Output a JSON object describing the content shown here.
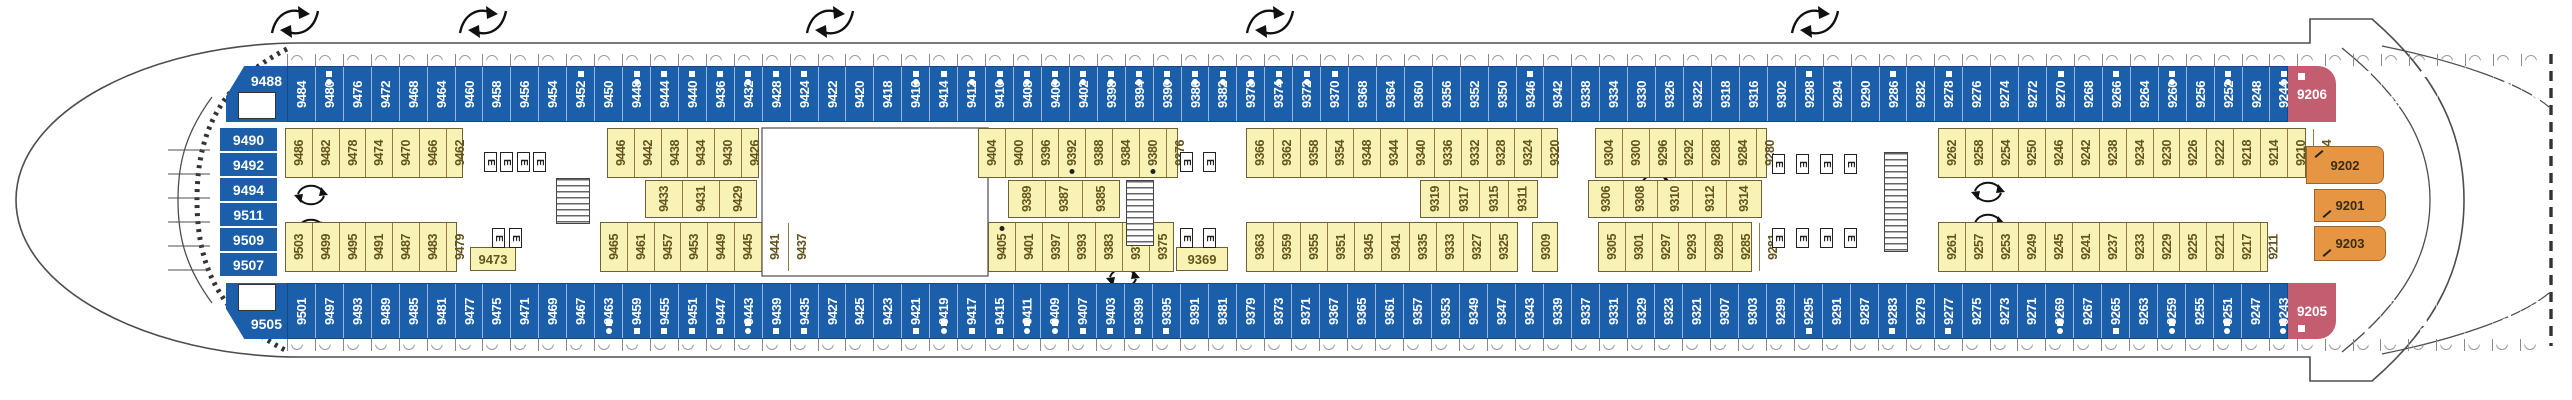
{
  "title": "ship-deck-plan",
  "colors": {
    "cabin_blue": "#1b5ea9",
    "cabin_yellow": "#f8f2b5",
    "cabin_pink": "#c35e70",
    "cabin_orange": "#e69643",
    "yellow_text": "#63531d",
    "hull_line": "#4d4d4d"
  },
  "left_labels": {
    "top": "9488",
    "column": [
      "9490",
      "9492",
      "9494",
      "9511",
      "9509",
      "9507"
    ],
    "bottom": "9505"
  },
  "blue_top": {
    "x": 287,
    "y": 66,
    "w": 2001,
    "h": 56,
    "cabins": [
      "9484",
      "9480",
      "9476",
      "9472",
      "9468",
      "9464",
      "9460",
      "9458",
      "9456",
      "9454",
      "9452",
      "9450",
      "9448",
      "9444",
      "9440",
      "9436",
      "9432",
      "9428",
      "9424",
      "9422",
      "9420",
      "9418",
      "9416",
      "9414",
      "9412",
      "9410",
      "9408",
      "9406",
      "9402",
      "9398",
      "9394",
      "9390",
      "9386",
      "9382",
      "9378",
      "9374",
      "9372",
      "9370",
      "9368",
      "9364",
      "9360",
      "9356",
      "9352",
      "9350",
      "9346",
      "9342",
      "9338",
      "9334",
      "9330",
      "9326",
      "9322",
      "9318",
      "9316",
      "9302",
      "9298",
      "9294",
      "9290",
      "9286",
      "9282",
      "9278",
      "9276",
      "9274",
      "9272",
      "9270",
      "9268",
      "9266",
      "9264",
      "9260",
      "9256",
      "9252",
      "9248",
      "9244",
      "9240",
      "9236",
      "9232",
      "9228",
      "9224",
      "9220",
      "9216",
      "9212",
      "9208"
    ]
  },
  "blue_bottom": {
    "x": 287,
    "y": 283,
    "w": 2001,
    "h": 56,
    "cabins": [
      "9501",
      "9497",
      "9493",
      "9489",
      "9485",
      "9481",
      "9477",
      "9475",
      "9471",
      "9469",
      "9467",
      "9463",
      "9459",
      "9455",
      "9451",
      "9447",
      "9443",
      "9439",
      "9435",
      "9427",
      "9425",
      "9423",
      "9421",
      "9419",
      "9417",
      "9415",
      "9411",
      "9409",
      "9407",
      "9403",
      "9399",
      "9395",
      "9391",
      "9381",
      "9379",
      "9373",
      "9371",
      "9367",
      "9365",
      "9361",
      "9357",
      "9353",
      "9349",
      "9347",
      "9343",
      "9339",
      "9337",
      "9331",
      "9329",
      "9323",
      "9321",
      "9307",
      "9303",
      "9299",
      "9295",
      "9291",
      "9287",
      "9283",
      "9279",
      "9277",
      "9275",
      "9273",
      "9271",
      "9269",
      "9267",
      "9265",
      "9263",
      "9259",
      "9255",
      "9251",
      "9247",
      "9243",
      "9239",
      "9235",
      "9231",
      "9227",
      "9223",
      "9219",
      "9215",
      "9209",
      "9207"
    ]
  },
  "marks": {
    "square_dot": [
      "9480",
      "9448",
      "9432",
      "9416",
      "9412",
      "9410",
      "9408",
      "9406",
      "9402",
      "9398",
      "9394",
      "9390",
      "9386",
      "9382",
      "9378",
      "9374",
      "9372",
      "9260",
      "9252",
      "9244",
      "9232",
      "9224",
      "9208",
      "9463",
      "9443",
      "9419",
      "9411",
      "9409",
      "9269",
      "9259",
      "9251",
      "9243",
      "9231",
      "9223"
    ],
    "square": [
      "9452",
      "9444",
      "9440",
      "9436",
      "9428",
      "9424",
      "9414",
      "9370",
      "9346",
      "9298",
      "9286",
      "9278",
      "9270",
      "9266",
      "9212",
      "9459",
      "9455",
      "9451",
      "9447",
      "9439",
      "9435",
      "9421",
      "9417",
      "9415",
      "9407",
      "9403",
      "9399",
      "9395",
      "9295",
      "9283",
      "9277",
      "9265",
      "9209",
      "9207"
    ],
    "dot_black": [
      "9392",
      "9380",
      "9405"
    ]
  },
  "yellow_upper": [
    {
      "x": 285,
      "w": 178,
      "cabins": [
        "9486",
        "9482",
        "9478",
        "9474",
        "9470",
        "9466",
        "9462"
      ]
    },
    {
      "x": 607,
      "w": 152,
      "cabins": [
        "9446",
        "9442",
        "9438",
        "9434",
        "9430",
        "9426"
      ]
    },
    {
      "x": 978,
      "w": 200,
      "cabins": [
        "9404",
        "9400",
        "9396",
        "9392",
        "9388",
        "9384",
        "9380",
        "9376"
      ]
    },
    {
      "x": 1246,
      "w": 312,
      "cabins": [
        "9366",
        "9362",
        "9358",
        "9354",
        "9348",
        "9344",
        "9340",
        "9336",
        "9332",
        "9328",
        "9324",
        "9320"
      ]
    },
    {
      "x": 1595,
      "w": 172,
      "cabins": [
        "9304",
        "9300",
        "9296",
        "9292",
        "9288",
        "9284",
        "9280"
      ]
    },
    {
      "x": 1938,
      "w": 368,
      "cabins": [
        "9262",
        "9258",
        "9254",
        "9250",
        "9246",
        "9242",
        "9238",
        "9234",
        "9230",
        "9226",
        "9222",
        "9218",
        "9214",
        "9210",
        "9204"
      ]
    }
  ],
  "inner_row": [
    {
      "x": 645,
      "w": 112,
      "cabins": [
        "9433",
        "9431",
        "9429"
      ]
    },
    {
      "x": 1008,
      "w": 112,
      "cabins": [
        "9389",
        "9387",
        "9385"
      ]
    },
    {
      "x": 1420,
      "w": 118,
      "cabins": [
        "9319",
        "9317",
        "9315",
        "9311"
      ]
    },
    {
      "x": 1588,
      "w": 174,
      "cabins": [
        "9306",
        "9308",
        "9310",
        "9312",
        "9314"
      ]
    }
  ],
  "yellow_lower": [
    {
      "x": 285,
      "w": 172,
      "cabins": [
        "9503",
        "9499",
        "9495",
        "9491",
        "9487",
        "9483",
        "9479"
      ]
    },
    {
      "x": 600,
      "w": 162,
      "cabins": [
        "9465",
        "9461",
        "9457",
        "9453",
        "9449",
        "9445",
        "9441",
        "9437"
      ]
    },
    {
      "x": 988,
      "w": 186,
      "cabins": [
        "9405",
        "9401",
        "9397",
        "9393",
        "9383",
        "9377",
        "9375"
      ]
    },
    {
      "x": 1246,
      "w": 272,
      "cabins": [
        "9363",
        "9359",
        "9355",
        "9351",
        "9345",
        "9341",
        "9335",
        "9333",
        "9327",
        "9325"
      ]
    },
    {
      "x": 1532,
      "w": 26,
      "cabins": [
        "9309"
      ]
    },
    {
      "x": 1598,
      "w": 154,
      "cabins": [
        "9305",
        "9301",
        "9297",
        "9293",
        "9289",
        "9285",
        "9281"
      ]
    },
    {
      "x": 1938,
      "w": 330,
      "cabins": [
        "9261",
        "9257",
        "9253",
        "9249",
        "9245",
        "9241",
        "9237",
        "9233",
        "9229",
        "9225",
        "9221",
        "9217",
        "9211"
      ]
    }
  ],
  "wide_cabins": [
    {
      "n": "9473",
      "x": 470,
      "y": 247,
      "w": 46,
      "h": 24
    },
    {
      "n": "9369",
      "x": 1176,
      "y": 247,
      "w": 52,
      "h": 24
    }
  ],
  "stern": {
    "pink": [
      {
        "n": "9206",
        "x": 2288,
        "y": 66,
        "w": 48,
        "h": 56,
        "corner": "top"
      },
      {
        "n": "9205",
        "x": 2288,
        "y": 283,
        "w": 48,
        "h": 56,
        "corner": "bottom"
      }
    ],
    "orange": [
      {
        "n": "9202",
        "x": 2306,
        "y": 146,
        "w": 78,
        "h": 38,
        "mark": "top"
      },
      {
        "n": "9201",
        "x": 2314,
        "y": 189,
        "w": 72,
        "h": 33,
        "mark": "bottom"
      },
      {
        "n": "9203",
        "x": 2314,
        "y": 226,
        "w": 72,
        "h": 35,
        "mark": "bottom"
      }
    ]
  },
  "fixtures": {
    "elevators": [
      [
        484,
        152
      ],
      [
        500,
        152
      ],
      [
        517,
        152
      ],
      [
        533,
        152
      ],
      [
        492,
        228
      ],
      [
        509,
        228
      ],
      [
        1180,
        152
      ],
      [
        1203,
        152
      ],
      [
        1180,
        228
      ],
      [
        1203,
        228
      ],
      [
        1772,
        154
      ],
      [
        1796,
        154
      ],
      [
        1820,
        154
      ],
      [
        1844,
        154
      ],
      [
        1772,
        228
      ],
      [
        1796,
        228
      ],
      [
        1820,
        228
      ],
      [
        1844,
        228
      ]
    ],
    "stairs": [
      [
        556,
        178,
        34,
        46
      ],
      [
        1126,
        180,
        28,
        66
      ],
      [
        1884,
        152,
        24,
        100
      ]
    ],
    "void_room": [
      762,
      128,
      226,
      148
    ]
  },
  "decor": {
    "arrows_top": [
      295,
      483,
      830,
      1270,
      1815
    ],
    "arrows_circle": [
      [
        311,
        193
      ],
      [
        311,
        227
      ],
      [
        1123,
        276
      ],
      [
        1655,
        182
      ],
      [
        1988,
        190
      ],
      [
        1988,
        222
      ]
    ],
    "triangle_pairs": [
      [
        1258,
        230
      ],
      [
        2292,
        171
      ]
    ]
  }
}
